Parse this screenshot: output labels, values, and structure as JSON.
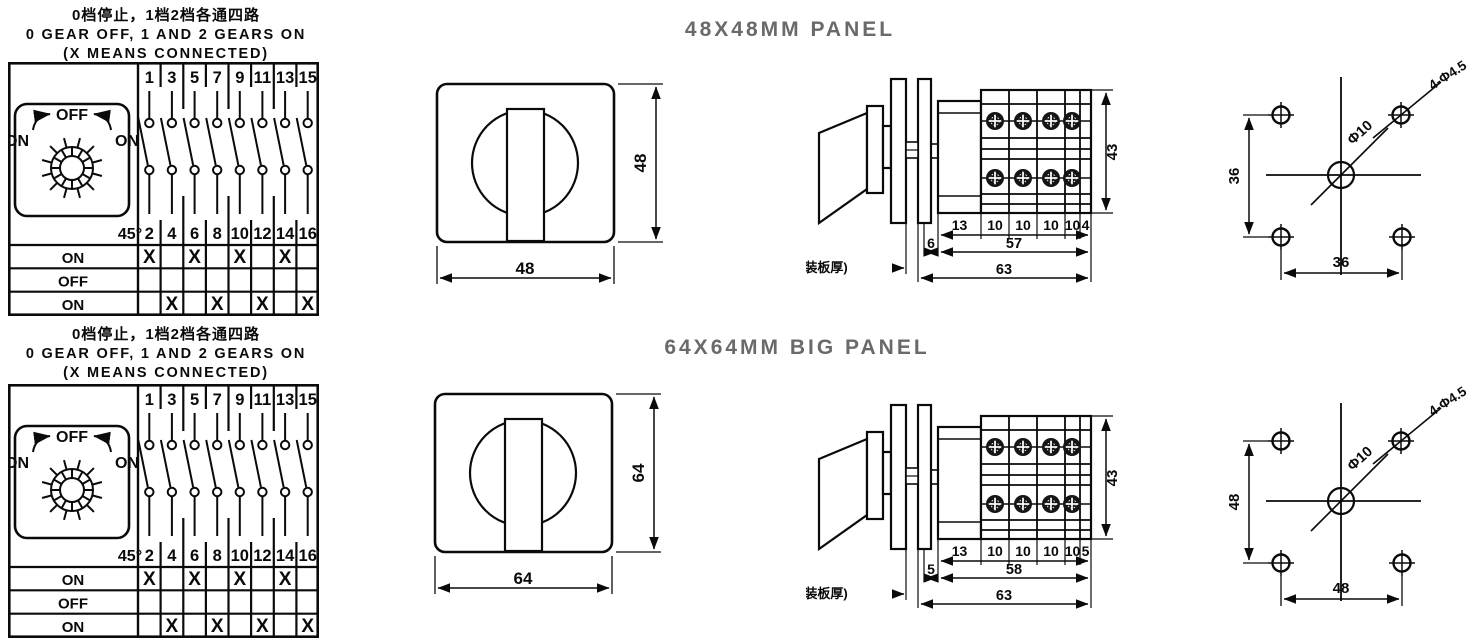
{
  "canvas": {
    "background": "#ffffff",
    "ink_color": "#0a0a0a",
    "title_color": "#6a6a6a"
  },
  "conn_table": {
    "heading": {
      "cn": "0档停止，1档2档各通四路",
      "en": "0 GEAR OFF, 1 AND 2 GEARS ON",
      "note": "(X MEANS CONNECTED)"
    },
    "dial": {
      "off_label": "OFF",
      "on_left": "ON",
      "on_right": "ON",
      "angle_label": "45°"
    },
    "top_terminals": [
      "1",
      "3",
      "5",
      "7",
      "9",
      "11",
      "13",
      "15"
    ],
    "bottom_terminals": [
      "2",
      "4",
      "6",
      "8",
      "10",
      "12",
      "14",
      "16"
    ],
    "state_rows": [
      {
        "label": "ON",
        "marks": [
          "X",
          "",
          "X",
          "",
          "X",
          "",
          "X",
          ""
        ]
      },
      {
        "label": "OFF",
        "marks": [
          "",
          "",
          "",
          "",
          "",
          "",
          "",
          ""
        ]
      },
      {
        "label": "ON",
        "marks": [
          "",
          "X",
          "",
          "X",
          "",
          "X",
          "",
          "X"
        ]
      }
    ]
  },
  "sections": [
    {
      "title": "48X48MM PANEL",
      "front": {
        "width_dim": "48",
        "height_dim": "48"
      },
      "side": {
        "segment_dims": [
          "13",
          "10",
          "10",
          "10",
          "10",
          "4"
        ],
        "gap_dim": "6",
        "span_dim": "57",
        "total_dim": "63",
        "height_dim": "43",
        "mount_label": "1-5(安装板厚)"
      },
      "holes": {
        "vertical_dim": "36",
        "horizontal_dim": "36",
        "center_hole_label": "Φ10",
        "corner_holes_label": "4-Φ4.5"
      }
    },
    {
      "title": "64X64MM BIG PANEL",
      "front": {
        "width_dim": "64",
        "height_dim": "64"
      },
      "side": {
        "segment_dims": [
          "13",
          "10",
          "10",
          "10",
          "10",
          "5"
        ],
        "gap_dim": "5",
        "span_dim": "58",
        "total_dim": "63",
        "height_dim": "43",
        "mount_label": "1-5(安装板厚)"
      },
      "holes": {
        "vertical_dim": "48",
        "horizontal_dim": "48",
        "center_hole_label": "Φ10",
        "corner_holes_label": "4-Φ4.5"
      }
    }
  ]
}
